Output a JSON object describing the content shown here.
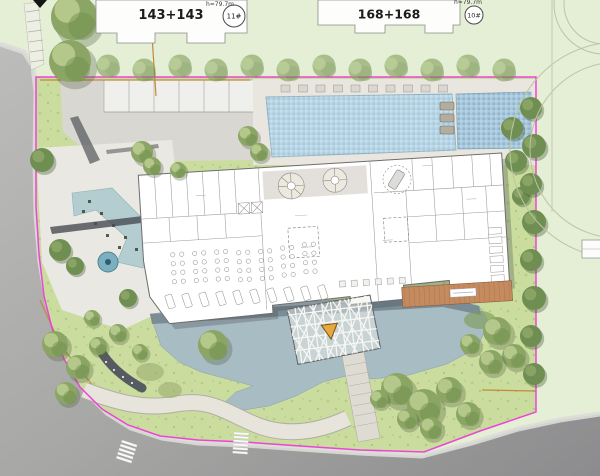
{
  "annotations": {
    "building_11": {
      "label": "143+143",
      "badge": "11#",
      "height_note": "h=79.7m"
    },
    "building_10": {
      "label": "168+168",
      "badge": "10#",
      "height_note": "h=79.7m"
    }
  },
  "colors": {
    "c-boundary": "#ee3bd7",
    "c-pool": "#b7d5e5",
    "c-pool2": "#a9cade",
    "c-pond": "#a8bcc3",
    "c-lawn": "#cadd9f",
    "c-lawnpale": "#e4efd6",
    "c-road": "#a8a8a6",
    "c-building": "#ffffff",
    "c-deck": "#c58a5e",
    "c-accent": "#e9a83b",
    "c-tree": "#8ba564",
    "c-waterf": "#b4cdd1"
  }
}
